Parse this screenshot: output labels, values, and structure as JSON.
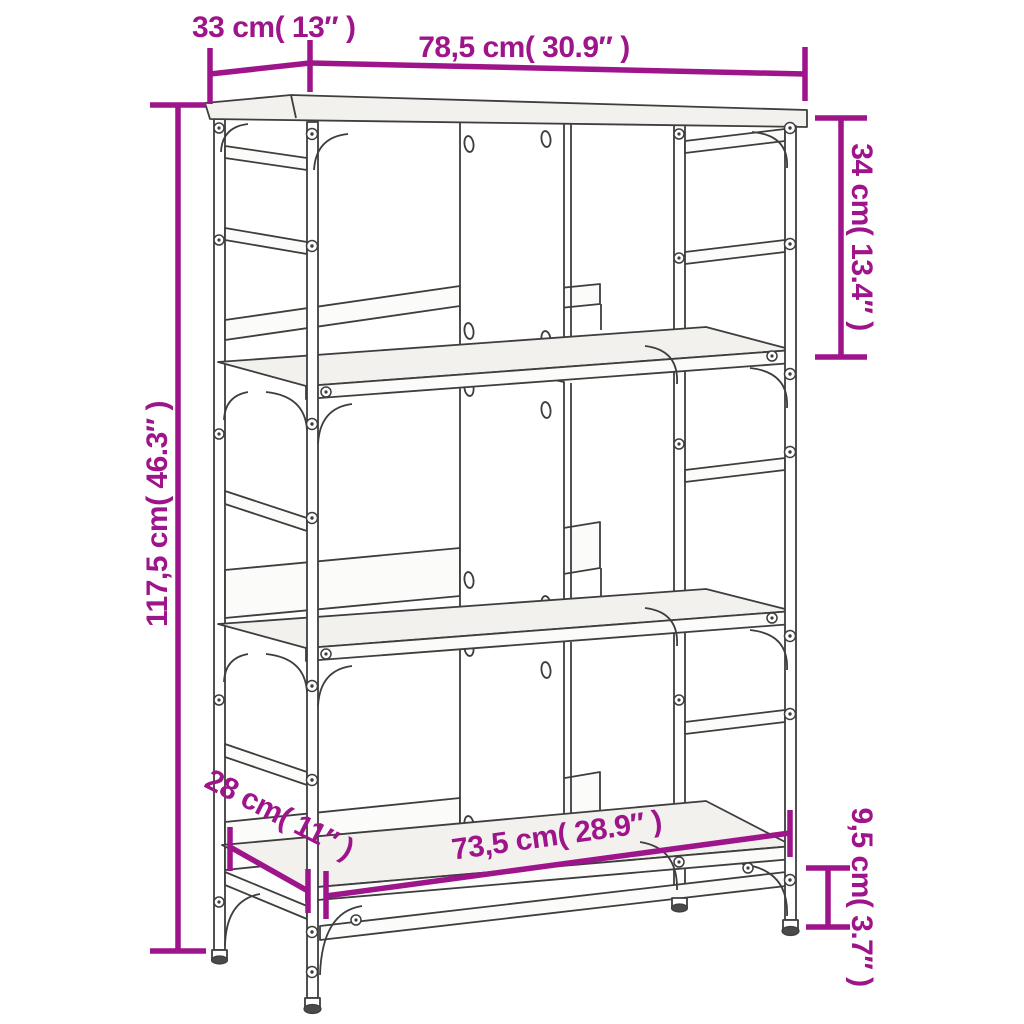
{
  "figure": {
    "type": "product-dimension-diagram",
    "subject": "bookshelf-line-drawing",
    "accent_color": "#9e148a",
    "line_color": "#3e3e3e",
    "background_color": "#ffffff"
  },
  "dimensions": {
    "top_depth": {
      "label": "33 cm( 13″ )"
    },
    "top_width": {
      "label": "78,5 cm( 30.9″ )"
    },
    "top_shelf_height": {
      "label": "34 cm( 13.4″ )"
    },
    "overall_height": {
      "label": "117,5 cm( 46.3″ )"
    },
    "bottom_depth": {
      "label": "28 cm( 11″ )"
    },
    "bottom_width": {
      "label": "73,5 cm( 28.9″ )"
    },
    "ground_clearance": {
      "label": "9,5 cm( 3.7″ )"
    }
  }
}
